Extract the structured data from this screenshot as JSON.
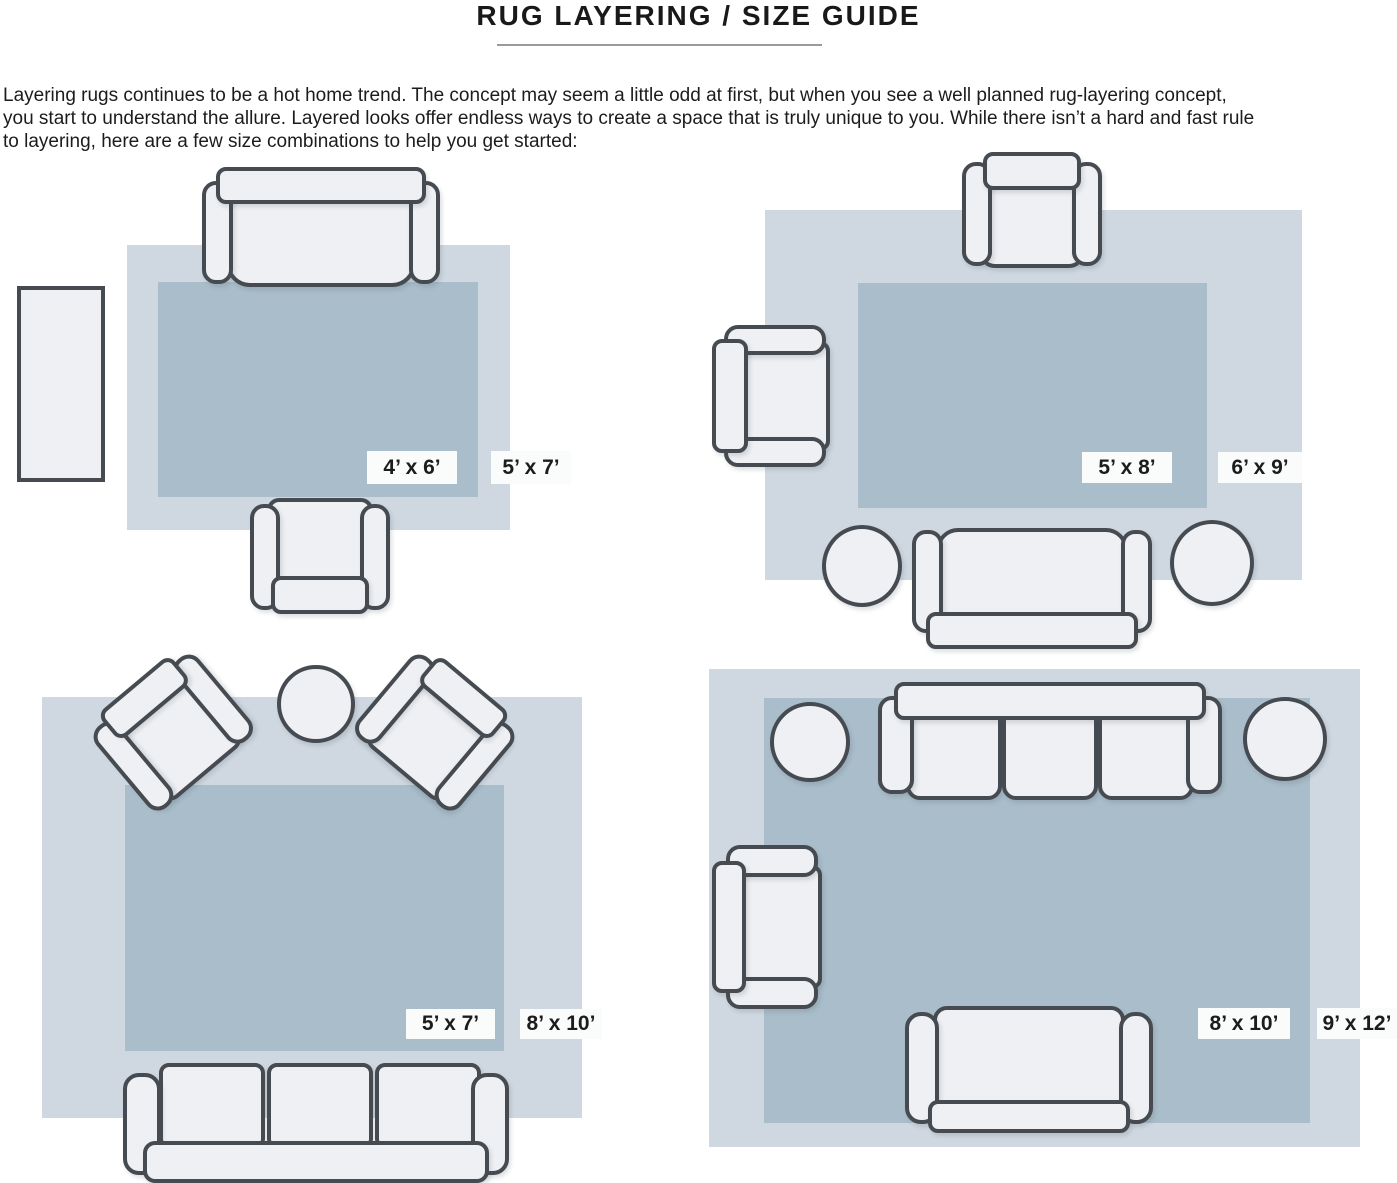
{
  "header": {
    "title": "RUG LAYERING / SIZE GUIDE",
    "intro_lines": [
      "Layering rugs continues to be a hot home trend. The concept may seem a little odd at first, but when you see a well planned rug-layering concept,",
      "you start to understand the allure. Layered looks offer endless ways to create a space that is truly unique to you. While there isn’t a hard and fast rule",
      "to layering, here are a few size combinations to help you get started:"
    ]
  },
  "colors": {
    "rug_outer": "#cfd8e1",
    "rug_inner": "#a9bdca",
    "furniture_fill": "#eef0f3",
    "furniture_outline": "#464b51",
    "label_background": "#fafbfb",
    "text": "#1c1c1c"
  },
  "diagrams": {
    "top_left": {
      "layout": "sofa, armchair and console table around layered rugs",
      "inner_size": "4’ x 6’",
      "outer_size": "5’ x 7’"
    },
    "top_right": {
      "layout": "armchair, side chair, sofa and two round ottomans around layered rugs",
      "inner_size": "5’ x 8’",
      "outer_size": "6’ x 9’"
    },
    "bottom_left": {
      "layout": "two angled armchairs, round table and three-seat sofa around layered rugs",
      "inner_size": "5’ x 7’",
      "outer_size": "8’ x 10’"
    },
    "bottom_right": {
      "layout": "three-seat sofa, two round ottomans, side chair and loveseat around layered rugs",
      "inner_size": "8’ x 10’",
      "outer_size": "9’ x 12’"
    }
  }
}
